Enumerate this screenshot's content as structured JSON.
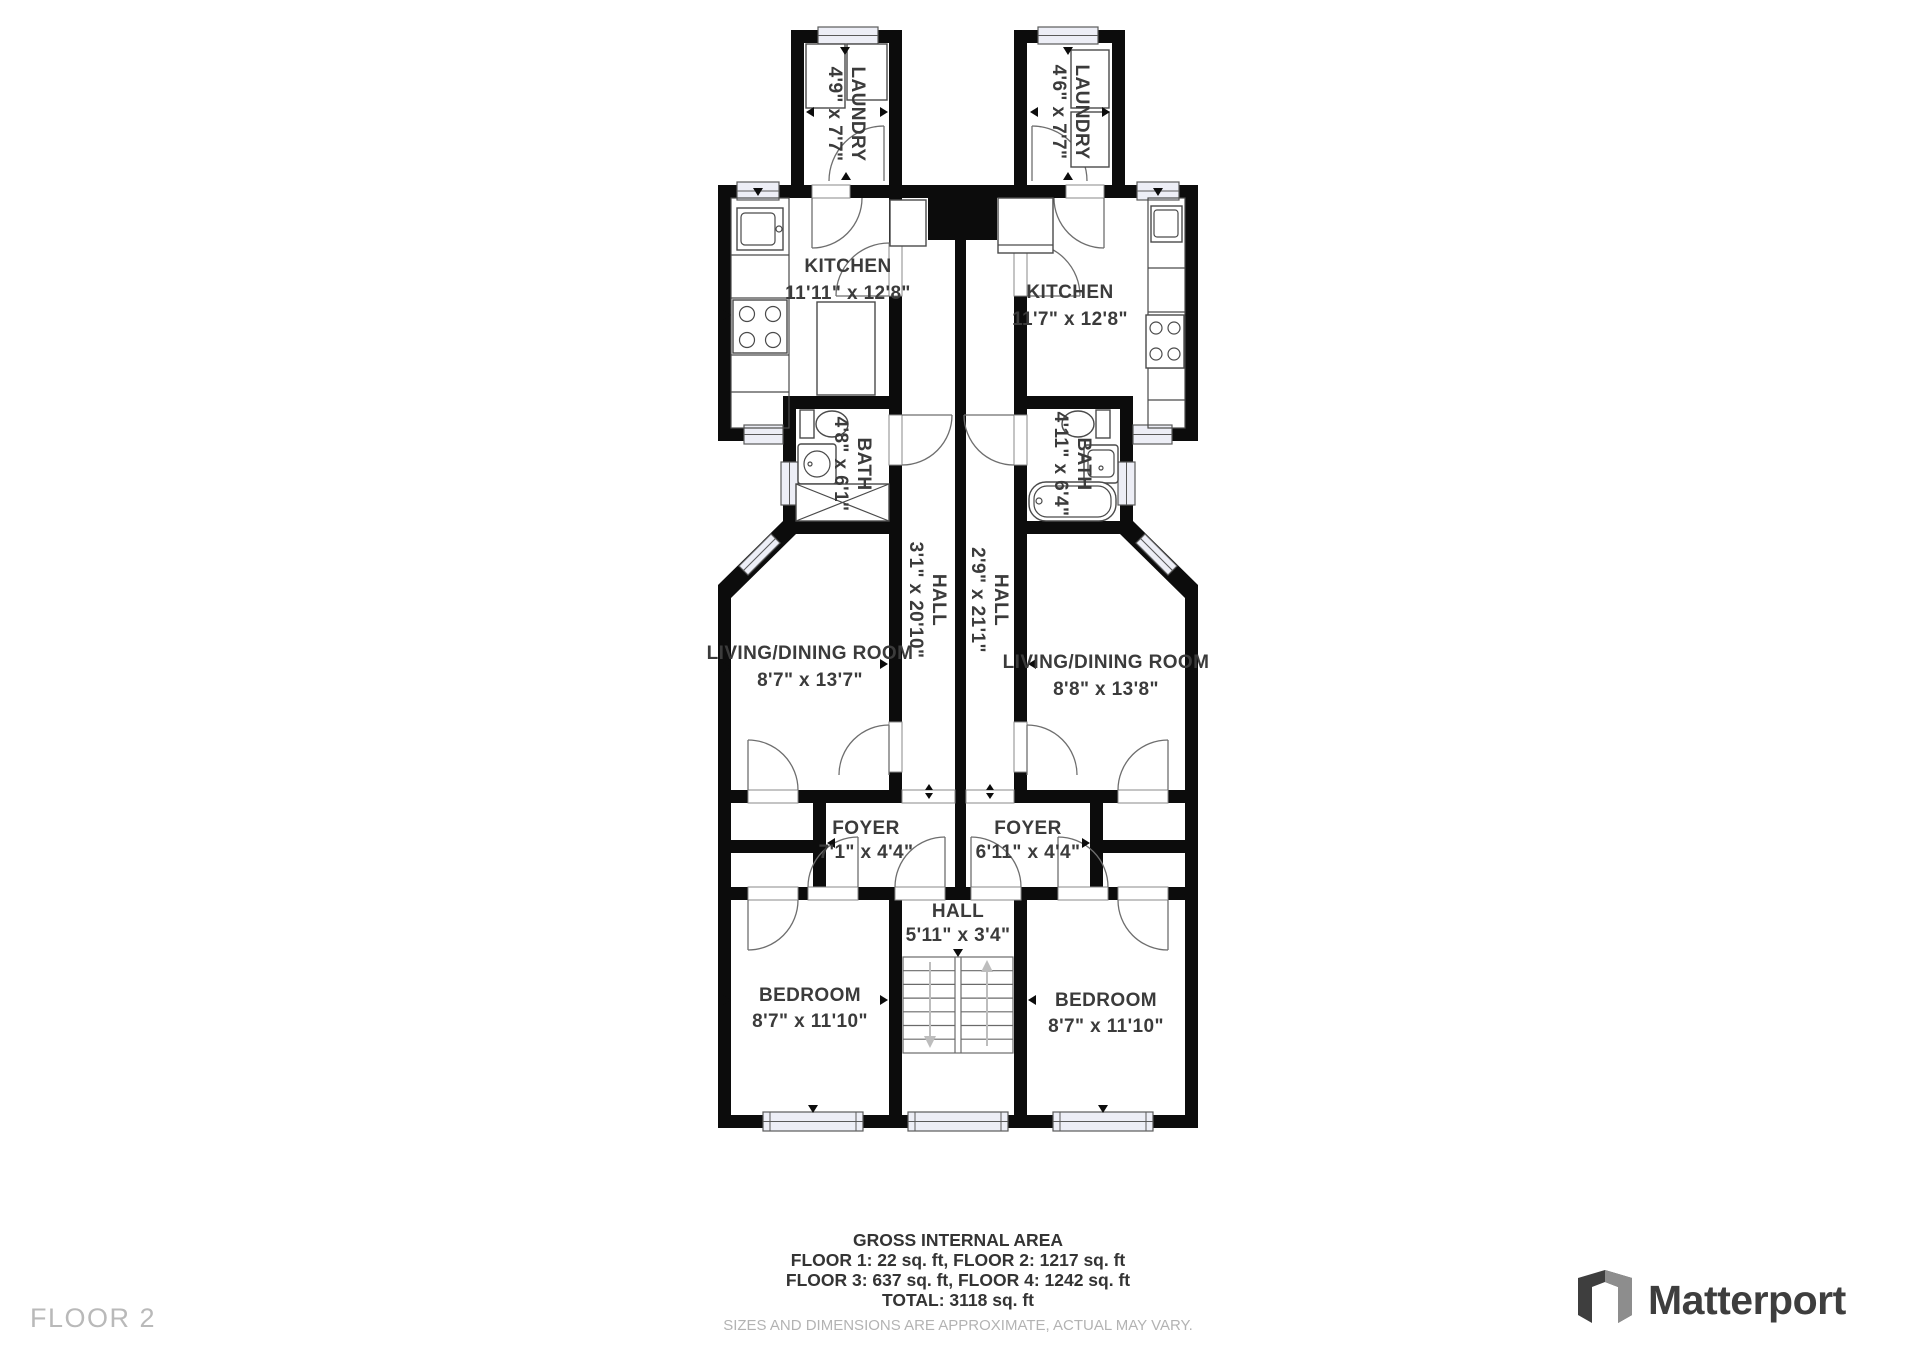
{
  "rooms": [
    {
      "id": "laundry-left",
      "name": "LAUNDRY",
      "dims": "4'9\" x 7'7\""
    },
    {
      "id": "laundry-right",
      "name": "LAUNDRY",
      "dims": "4'6\" x 7'7\""
    },
    {
      "id": "kitchen-left",
      "name": "KITCHEN",
      "dims": "11'11\" x 12'8\""
    },
    {
      "id": "kitchen-right",
      "name": "KITCHEN",
      "dims": "11'7\" x 12'8\""
    },
    {
      "id": "bath-left",
      "name": "BATH",
      "dims": "4'8\" x 6'1\""
    },
    {
      "id": "bath-right",
      "name": "BATH",
      "dims": "4'11\" x 6'4\""
    },
    {
      "id": "hall-left",
      "name": "HALL",
      "dims": "3'1\" x 20'10\""
    },
    {
      "id": "hall-right",
      "name": "HALL",
      "dims": "2'9\" x 21'1\""
    },
    {
      "id": "living-left",
      "name": "LIVING/DINING ROOM",
      "dims": "8'7\" x 13'7\""
    },
    {
      "id": "living-right",
      "name": "LIVING/DINING ROOM",
      "dims": "8'8\" x 13'8\""
    },
    {
      "id": "foyer-left",
      "name": "FOYER",
      "dims": "7'1\" x 4'4\""
    },
    {
      "id": "foyer-right",
      "name": "FOYER",
      "dims": "6'11\" x 4'4\""
    },
    {
      "id": "hall-center",
      "name": "HALL",
      "dims": "5'11\" x 3'4\""
    },
    {
      "id": "bedroom-left",
      "name": "BEDROOM",
      "dims": "8'7\" x 11'10\""
    },
    {
      "id": "bedroom-right",
      "name": "BEDROOM",
      "dims": "8'7\" x 11'10\""
    }
  ],
  "footer": {
    "title": "GROSS INTERNAL AREA",
    "line1": "FLOOR 1: 22 sq. ft, FLOOR 2: 1217 sq. ft",
    "line2": "FLOOR 3: 637 sq. ft, FLOOR 4: 1242 sq. ft",
    "total": "TOTAL: 3118 sq. ft",
    "disclaimer": "SIZES AND DIMENSIONS ARE APPROXIMATE, ACTUAL MAY VARY."
  },
  "floor_label": "FLOOR 2",
  "brand": {
    "name": "Matterport",
    "icon": "matterport-mark"
  },
  "colors": {
    "wall": "#0c0c0c",
    "label": "#3b3b3b",
    "muted": "#b3b3b3",
    "window": "#edeef6"
  }
}
